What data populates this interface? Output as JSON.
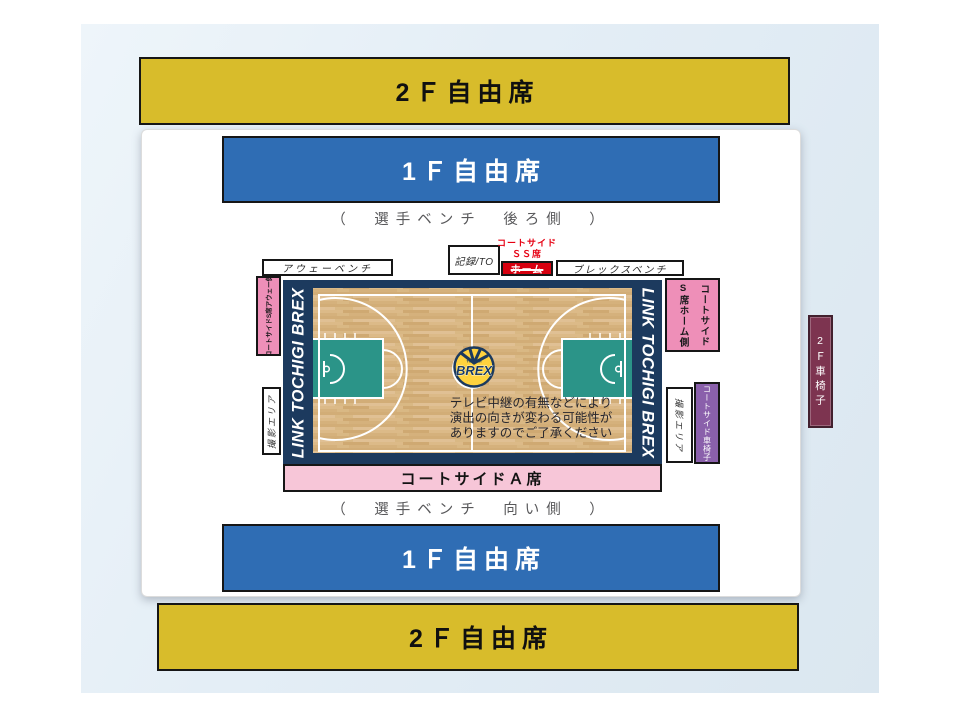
{
  "arena": {
    "stands": {
      "free_2f_top": "2Ｆ自由席",
      "free_1f_top": "1Ｆ自由席",
      "free_1f_bottom": "1Ｆ自由席",
      "free_2f_bottom": "2Ｆ自由席"
    },
    "notes": {
      "bench_back": "（　選手ベンチ　後ろ側　）",
      "bench_front": "（　選手ベンチ　向い側　）"
    },
    "labels": {
      "away_bench": "アウェーベンチ",
      "record_to": "記録/TO",
      "ss_seat_line1": "コートサイド",
      "ss_seat_line2": "ＳＳ席",
      "ss_home": "ホーム",
      "brex_bench": "ブレックスベンチ",
      "s_seat_away": "コートサイドS席アウェー側",
      "s_seat_home_line1": "コートサイド",
      "s_seat_home_line2": "S席ホーム側",
      "photo_area_left": "撮影エリア",
      "photo_area_right": "撮影エリア",
      "courtside_wheelchair": "コートサイド車椅子",
      "wheelchair_2f": "2Ｆ車椅子",
      "courtside_a": "コートサイドＡ席"
    },
    "court": {
      "brand_left": "LINK TOCHIGI BREX",
      "brand_right": "LINK TOCHIGI BREX",
      "logo_sub": "TOCHIGI",
      "logo_main": "BREX",
      "notice_line1": "テレビ中継の有無などにより",
      "notice_line2": "演出の向きが変わる可能性が",
      "notice_line3": "ありますのでご了承ください"
    },
    "colors": {
      "free_2f": "#d8bc2b",
      "free_1f": "#2f6db4",
      "courtside_a": "#f7c6d8",
      "courtside_s": "#ee8fb8",
      "courtside_ss": "#d7000f",
      "courtside_wheelchair": "#8a60ab",
      "wheelchair_2f": "#7d3450",
      "court_border_navy": "#1c3a5e",
      "court_paint_teal": "#2b9488",
      "court_floor_wood": "#d9b884"
    }
  }
}
